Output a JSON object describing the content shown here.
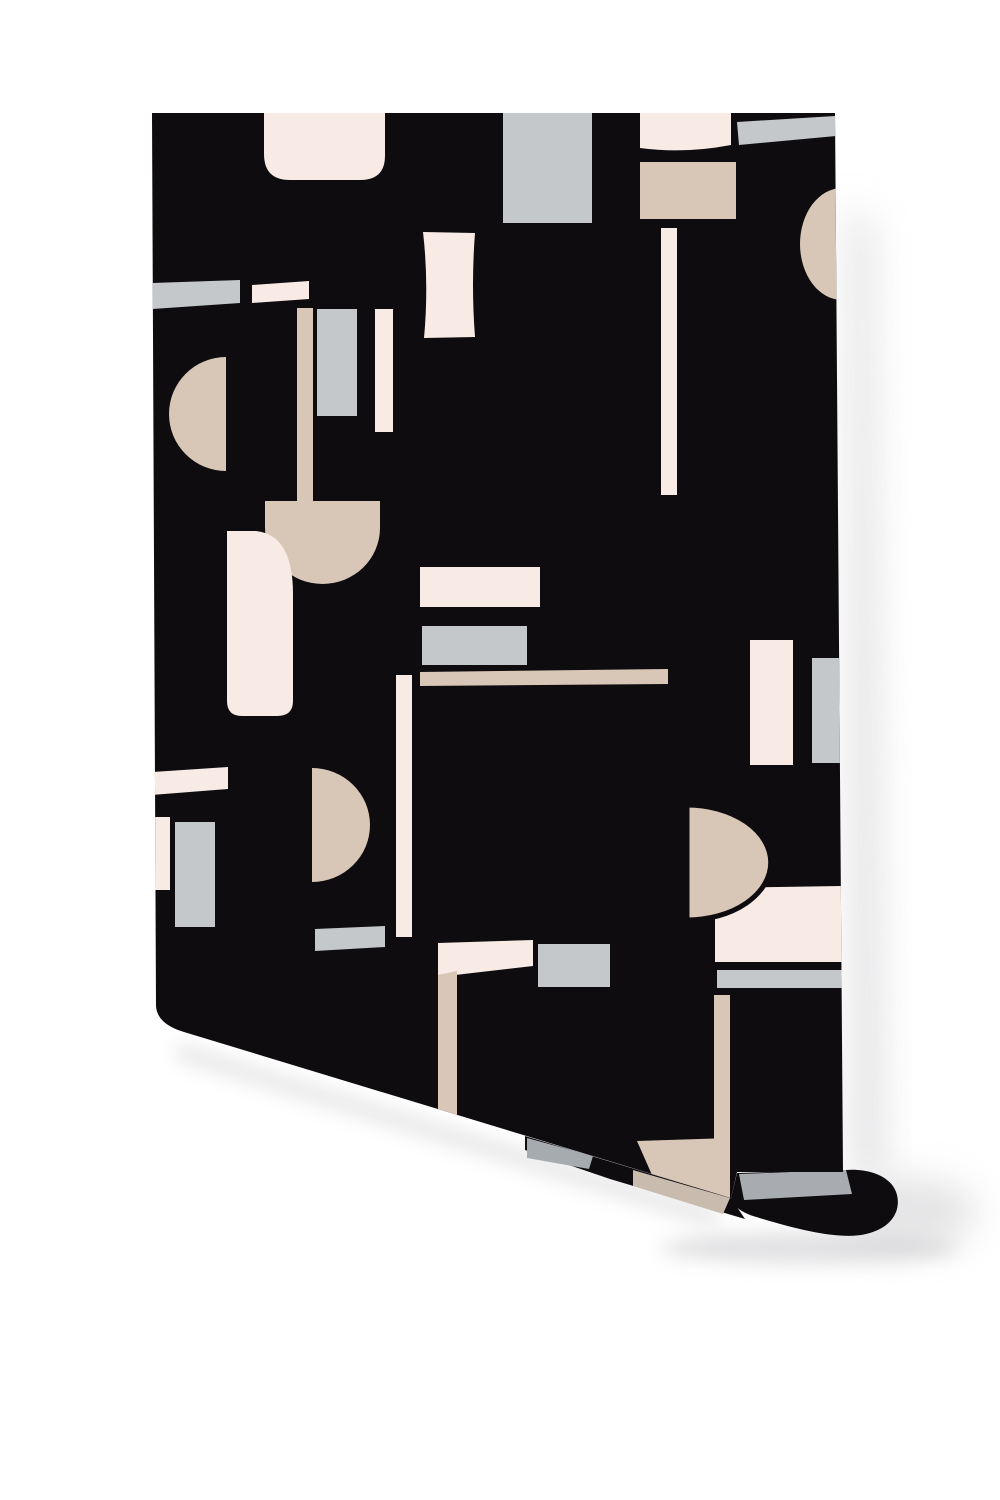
{
  "scene": {
    "description": "Mockup of a wallpaper roll: black paper with abstract cream, tan and gray geometric shapes, bottom edge curling back toward the lower right, soft shadows on a white background",
    "background": "#ffffff"
  },
  "colors": {
    "black": "#0e0c0f",
    "cream": "#f8ebe5",
    "tan": "#d8c6b7",
    "gray": "#c5c8cb",
    "curl_gray": "#a8acb0",
    "under_gray": "#a6abaf",
    "under_tan": "#cabbaf",
    "shadow": "#c9c9cc"
  },
  "roll": {
    "sheet_d": "M152,113 L835,113 L843,1172 L737,1172 L731,1198 L184,1032 Q157,1024 156,1006 Z",
    "curl_black_d": "M731,1198 C733,1206 741,1212 753,1216 C801,1231 842,1240 866,1234 C891,1228 901,1212 897,1195 C893,1178 872,1168 845,1170 L737,1173 Z",
    "curl_gray_bar_d": "M739,1174 L846,1170 L852,1194 L744,1200 Z",
    "under_black_d": "M525,1136 L731,1198 L745,1219 L610,1179 L525,1150 Z",
    "under_gray_d": "M527,1138 L593,1156 L589,1169 L527,1158 Z",
    "under_tan_d": "M633,1170 L730,1198 L723,1214 L633,1186 Z",
    "shadow_right_d": "M849,200 L873,230 L884,1180 L852,1172 Z",
    "shadow_corner_d": "M838,1212 A70,34 0 1 0 978,1212 A70,34 0 1 0 838,1212 Z",
    "shadow_curl_d": "M660,1248 A150,16 0 1 0 960,1248 A150,16 0 1 0 660,1248 Z",
    "shadow_diag_d": "M180,1042 L722,1210 L712,1228 L174,1060 Z"
  },
  "pattern_shapes": [
    {
      "name": "top-cream-rounded-rect",
      "fill": "cream",
      "d": "M264,113 L385,113 L385,156 Q385,180 360,180 L290,180 Q264,180 264,154 Z"
    },
    {
      "name": "top-gray-rect",
      "fill": "gray",
      "d": "M503,113 L592,113 L592,223 L503,223 Z"
    },
    {
      "name": "top-cream-small-rect",
      "fill": "cream",
      "d": "M640,113 L731,113 L731,145 Q684,154 640,148 Z"
    },
    {
      "name": "top-gray-slanted-bar",
      "fill": "gray",
      "d": "M737,122 L835,116 L836,136 L739,145 Z"
    },
    {
      "name": "top-tan-rect",
      "fill": "tan",
      "d": "M640,162 L736,162 L736,219 L640,219 Z"
    },
    {
      "name": "right-edge-tan-halfdisc",
      "fill": "tan",
      "d": "M842,188 A42,56 0 0 0 842,300 Z"
    },
    {
      "name": "cream-tall-rect",
      "fill": "cream",
      "d": "M423,232 L475,233 Q471,285 475,337 L424,338 Q429,284 423,232 Z"
    },
    {
      "name": "left-gray-bar",
      "fill": "gray",
      "d": "M152,283 L240,280 L240,303 L152,309 Z"
    },
    {
      "name": "cream-short-bar",
      "fill": "cream",
      "d": "M252,285 L309,281 L309,299 L252,303 Z"
    },
    {
      "name": "tan-stem-bar",
      "fill": "tan",
      "d": "M297,308 L313,308 L313,505 L297,505 Z"
    },
    {
      "name": "gray-small-vrect",
      "fill": "gray",
      "d": "M317,309 L357,309 L357,416 L317,416 Z"
    },
    {
      "name": "cream-vbar-a",
      "fill": "cream",
      "d": "M375,309 L393,309 L393,432 L375,432 Z"
    },
    {
      "name": "cream-vbar-b",
      "fill": "cream",
      "d": "M661,228 L677,228 L677,495 L661,495 Z"
    },
    {
      "name": "tan-halfdisc-flat-right",
      "fill": "tan",
      "d": "M226,357 A57,57 0 0 0 226,471 Z"
    },
    {
      "name": "tan-arch",
      "fill": "tan",
      "d": "M265,501 L380,501 L380,528 A57.5,56 0 0 1 265,528 Z"
    },
    {
      "name": "cream-bottle-rect",
      "fill": "cream",
      "d": "M227,531 L256,531 Q293,535 293,594 L293,701 Q293,716 277,716 L242,716 Q227,716 227,701 Z"
    },
    {
      "name": "cream-hrect",
      "fill": "cream",
      "d": "M420,567 L540,567 L540,607 L420,607 Z"
    },
    {
      "name": "gray-hrect",
      "fill": "gray",
      "d": "M422,626 L527,626 L527,665 L422,665 Z"
    },
    {
      "name": "tan-long-bar",
      "fill": "tan",
      "d": "M420,672 L668,669 L668,684 L420,686 Z"
    },
    {
      "name": "cream-vbar-c",
      "fill": "cream",
      "d": "M396,675 L412,675 L412,937 L396,937 Z"
    },
    {
      "name": "cream-vrect-right",
      "fill": "cream",
      "d": "M750,640 L793,640 L793,765 L750,765 Z"
    },
    {
      "name": "gray-rect-right-edge",
      "fill": "gray",
      "d": "M812,658 L847,658 L847,763 L812,763 Z"
    },
    {
      "name": "cream-bar-left-edge",
      "fill": "cream",
      "d": "M152,772 L228,767 L228,789 L152,795 Z"
    },
    {
      "name": "tan-halfdisc-flat-left",
      "fill": "tan",
      "d": "M312,768 A58,57 0 0 1 312,882 Z"
    },
    {
      "name": "cream-vbar-left-edge",
      "fill": "cream",
      "d": "M152,817 L170,817 L170,890 L152,890 Z"
    },
    {
      "name": "gray-vrect-left",
      "fill": "gray",
      "d": "M175,822 L215,822 L215,927 L175,927 Z"
    },
    {
      "name": "cream-big-rect",
      "fill": "cream",
      "d": "M715,888 L843,886 L843,962 L715,962 Z"
    },
    {
      "name": "tan-d-shape",
      "fill": "tan",
      "outline": true,
      "d": "M687,805 A83,57 0 0 1 687,920 Z"
    },
    {
      "name": "gray-bar-under-cream",
      "fill": "gray",
      "d": "M717,970 L843,970 L843,988 L717,988 Z"
    },
    {
      "name": "gray-slanted-bar-mid",
      "fill": "gray",
      "d": "M315,929 L385,926 L385,947 L315,951 Z"
    },
    {
      "name": "cream-l-bar",
      "fill": "cream",
      "d": "M438,943 L533,940 L533,966 L438,977 Z"
    },
    {
      "name": "tan-descender",
      "fill": "tan",
      "d": "M438,975 L457,971 L457,1125 L438,1125 Z"
    },
    {
      "name": "gray-rect-bottom",
      "fill": "gray",
      "d": "M538,944 L610,944 L610,987 L538,987 Z"
    },
    {
      "name": "tan-vbar-bottom",
      "fill": "tan",
      "d": "M714,995 L730,995 L730,1142 L714,1142 Z"
    },
    {
      "name": "tan-quad-bottom",
      "fill": "tan",
      "d": "M637,1141 L730,1138 L730,1200 L652,1175 Z"
    }
  ]
}
